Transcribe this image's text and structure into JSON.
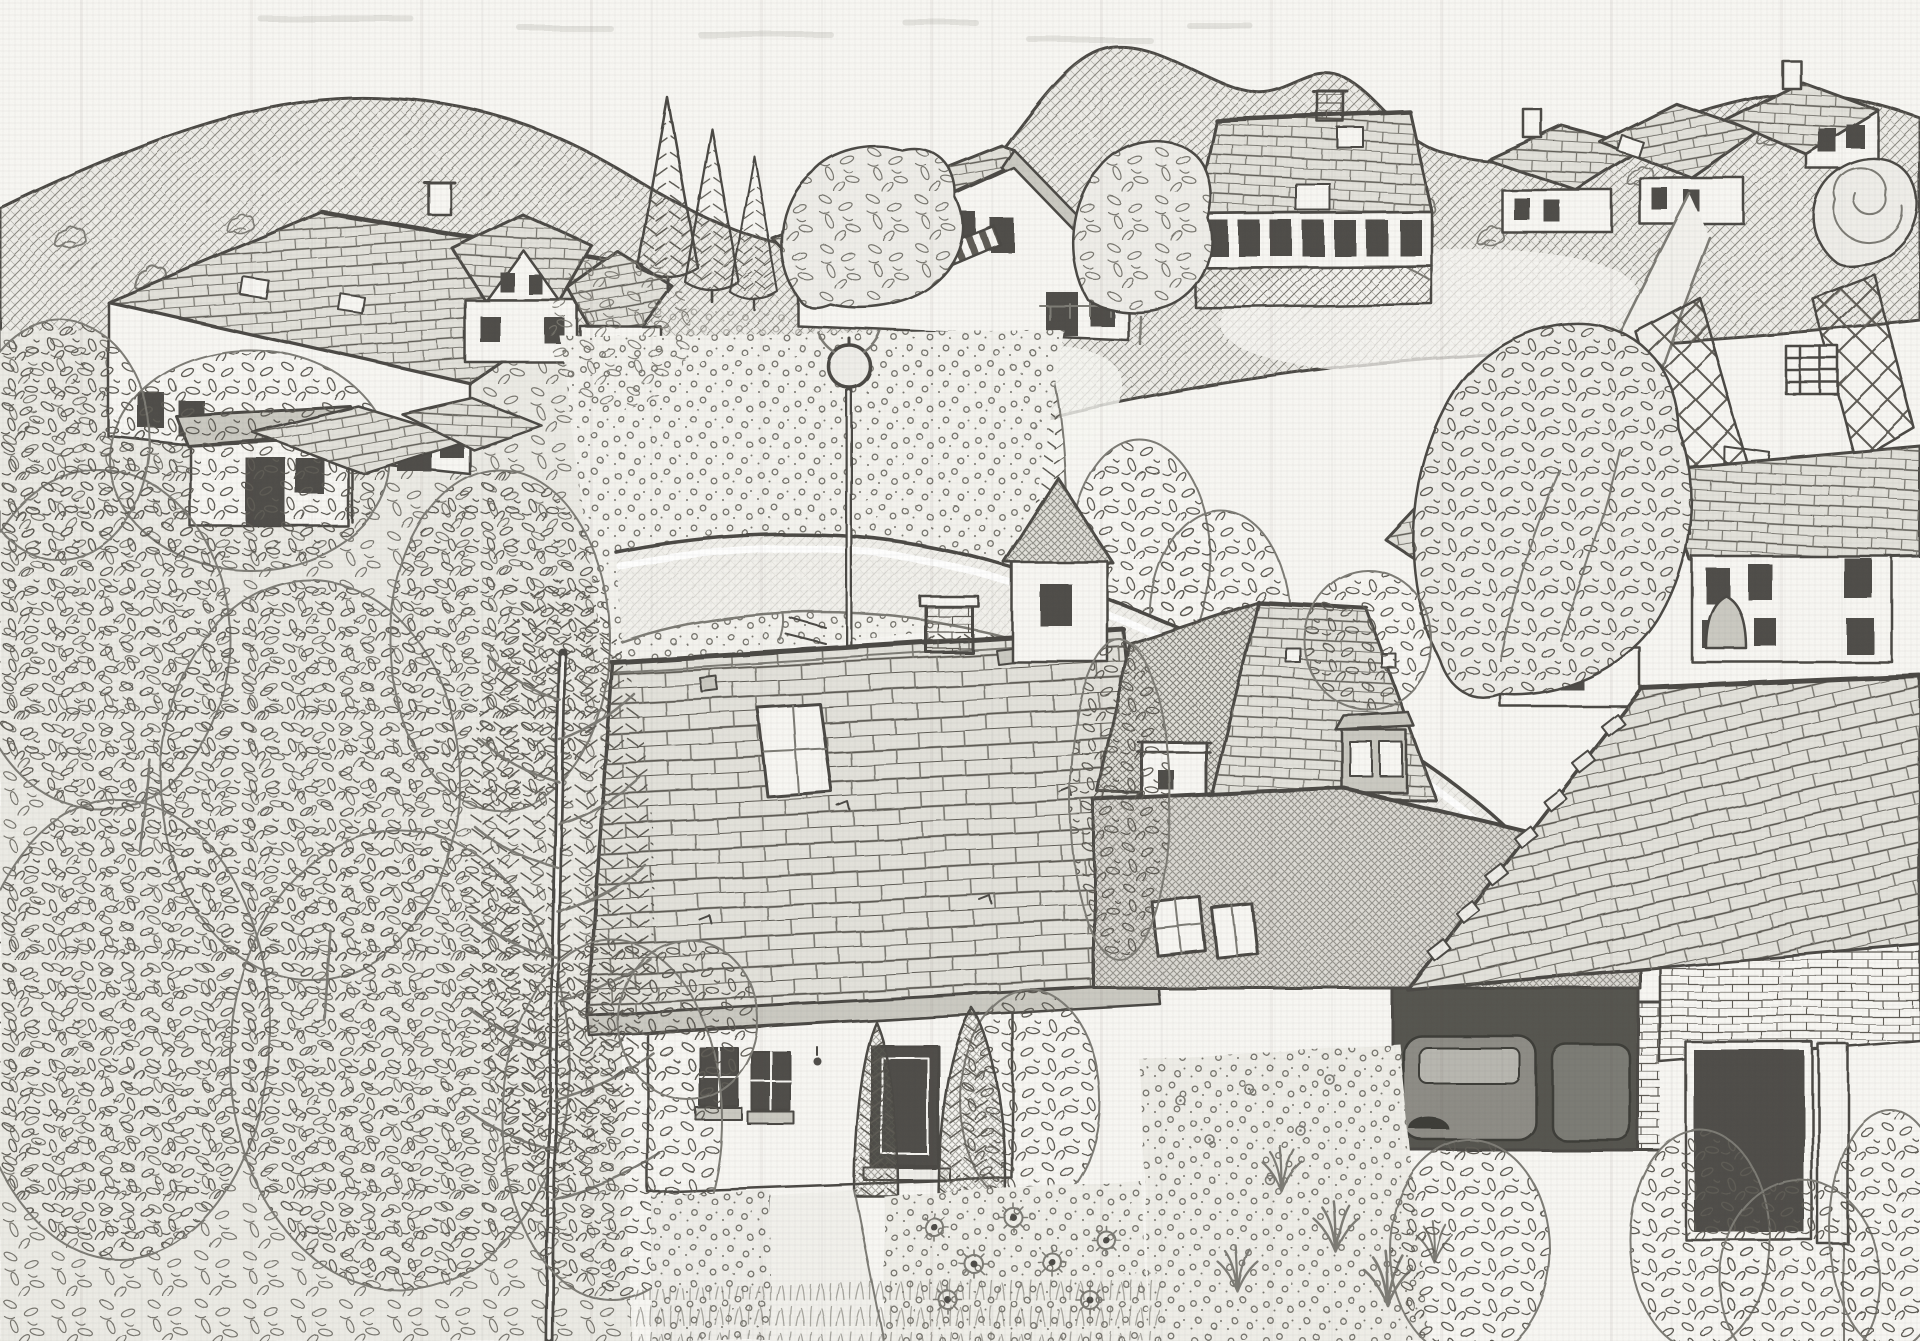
{
  "meta": {
    "title": "Pencil sketch of a hillside village with tiled roofs, gardens and a curving street",
    "medium": "graphite pencil on textured paper",
    "palette": {
      "paper": "#f8f7f3",
      "line": "#4c4a45",
      "line_soft": "#7d7b75",
      "texture": "#79776f",
      "texture_dark": "#5e5c55",
      "fill_light": "#efeee9",
      "fill_mid": "#e3e2db",
      "fill_dark": "#cbcac2",
      "window": "#4f4e49",
      "road": "#f3f2ed",
      "car": "#8e8d86",
      "car_glass": "#b8b7b0",
      "garage_dark": "#56554f"
    }
  },
  "scene": {
    "setting": "village on a wooded hillside seen from above, hand drawn, monochrome graphite",
    "sky": {
      "desc": "blank paper sky with faint smudges above rolling hill ridge"
    },
    "hills": {
      "desc": "cross-hatched rolling hills with scattered shrubs, pale meadow paths and dotted orchard rows"
    },
    "buildings": [
      {
        "name": "upper-left-farmhouse",
        "desc": "long tiled roof, two skylights, white wall with windows, low white annex with slab roof and ball lamp"
      },
      {
        "name": "gable-house-left",
        "desc": "small house with chimney and white gable, two windows"
      },
      {
        "name": "small-house-left",
        "desc": "cottage with hipped roof at edge of orchard"
      },
      {
        "name": "center-gable-house",
        "desc": "steep gabled house with striped awning and deck rail"
      },
      {
        "name": "large-house-top-center",
        "desc": "big hipped roof with two skylights, brick chimney, band of seven windows and hatched balcony"
      },
      {
        "name": "right-house-row",
        "desc": "three gabled houses with chimneys stepping down the ridge"
      },
      {
        "name": "mid-right-house",
        "desc": "tiled roof house with chimney above the lane"
      },
      {
        "name": "white-house-right",
        "desc": "two storey white house with six dark windows and bell shaped shrub"
      },
      {
        "name": "middle-house",
        "desc": "foreshortened hip roof with dormer of two windows, roof vents and white utility box by the road"
      },
      {
        "name": "foreground-house",
        "desc": "large tiled roof with skylight and brick chimney, white facade with two windows, lamp and door"
      },
      {
        "name": "garage",
        "desc": "flat hatched roof with two skylights, open front with parked car, brick pillar"
      },
      {
        "name": "large-roof-right",
        "desc": "huge tiled roof with quoin blocks, brick wall below with dark doorway"
      }
    ],
    "street": {
      "desc": "curving lane from center-left sweeping to lower right, white curb line, four white paving marks, manhole ring, globe street lamp on tall pole"
    },
    "vegetation": [
      {
        "name": "orchard-left",
        "desc": "dense leafy orchard filling the left third, tree canopies and two small roofs peeking out"
      },
      {
        "name": "tall-conifer",
        "desc": "tall feathery conifer with pale trunk left of the foreground house"
      },
      {
        "name": "flower-meadow",
        "desc": "meadow dotted with small flowers above the street"
      },
      {
        "name": "garden",
        "desc": "front garden with sunflowers, two junipers by the door, flower beds, grass tufts and rose bush"
      },
      {
        "name": "trees",
        "desc": "conifer group, leafy canopies between houses, swirl tree at top right, lattice fenced footpath with gate and stairs"
      }
    ]
  }
}
